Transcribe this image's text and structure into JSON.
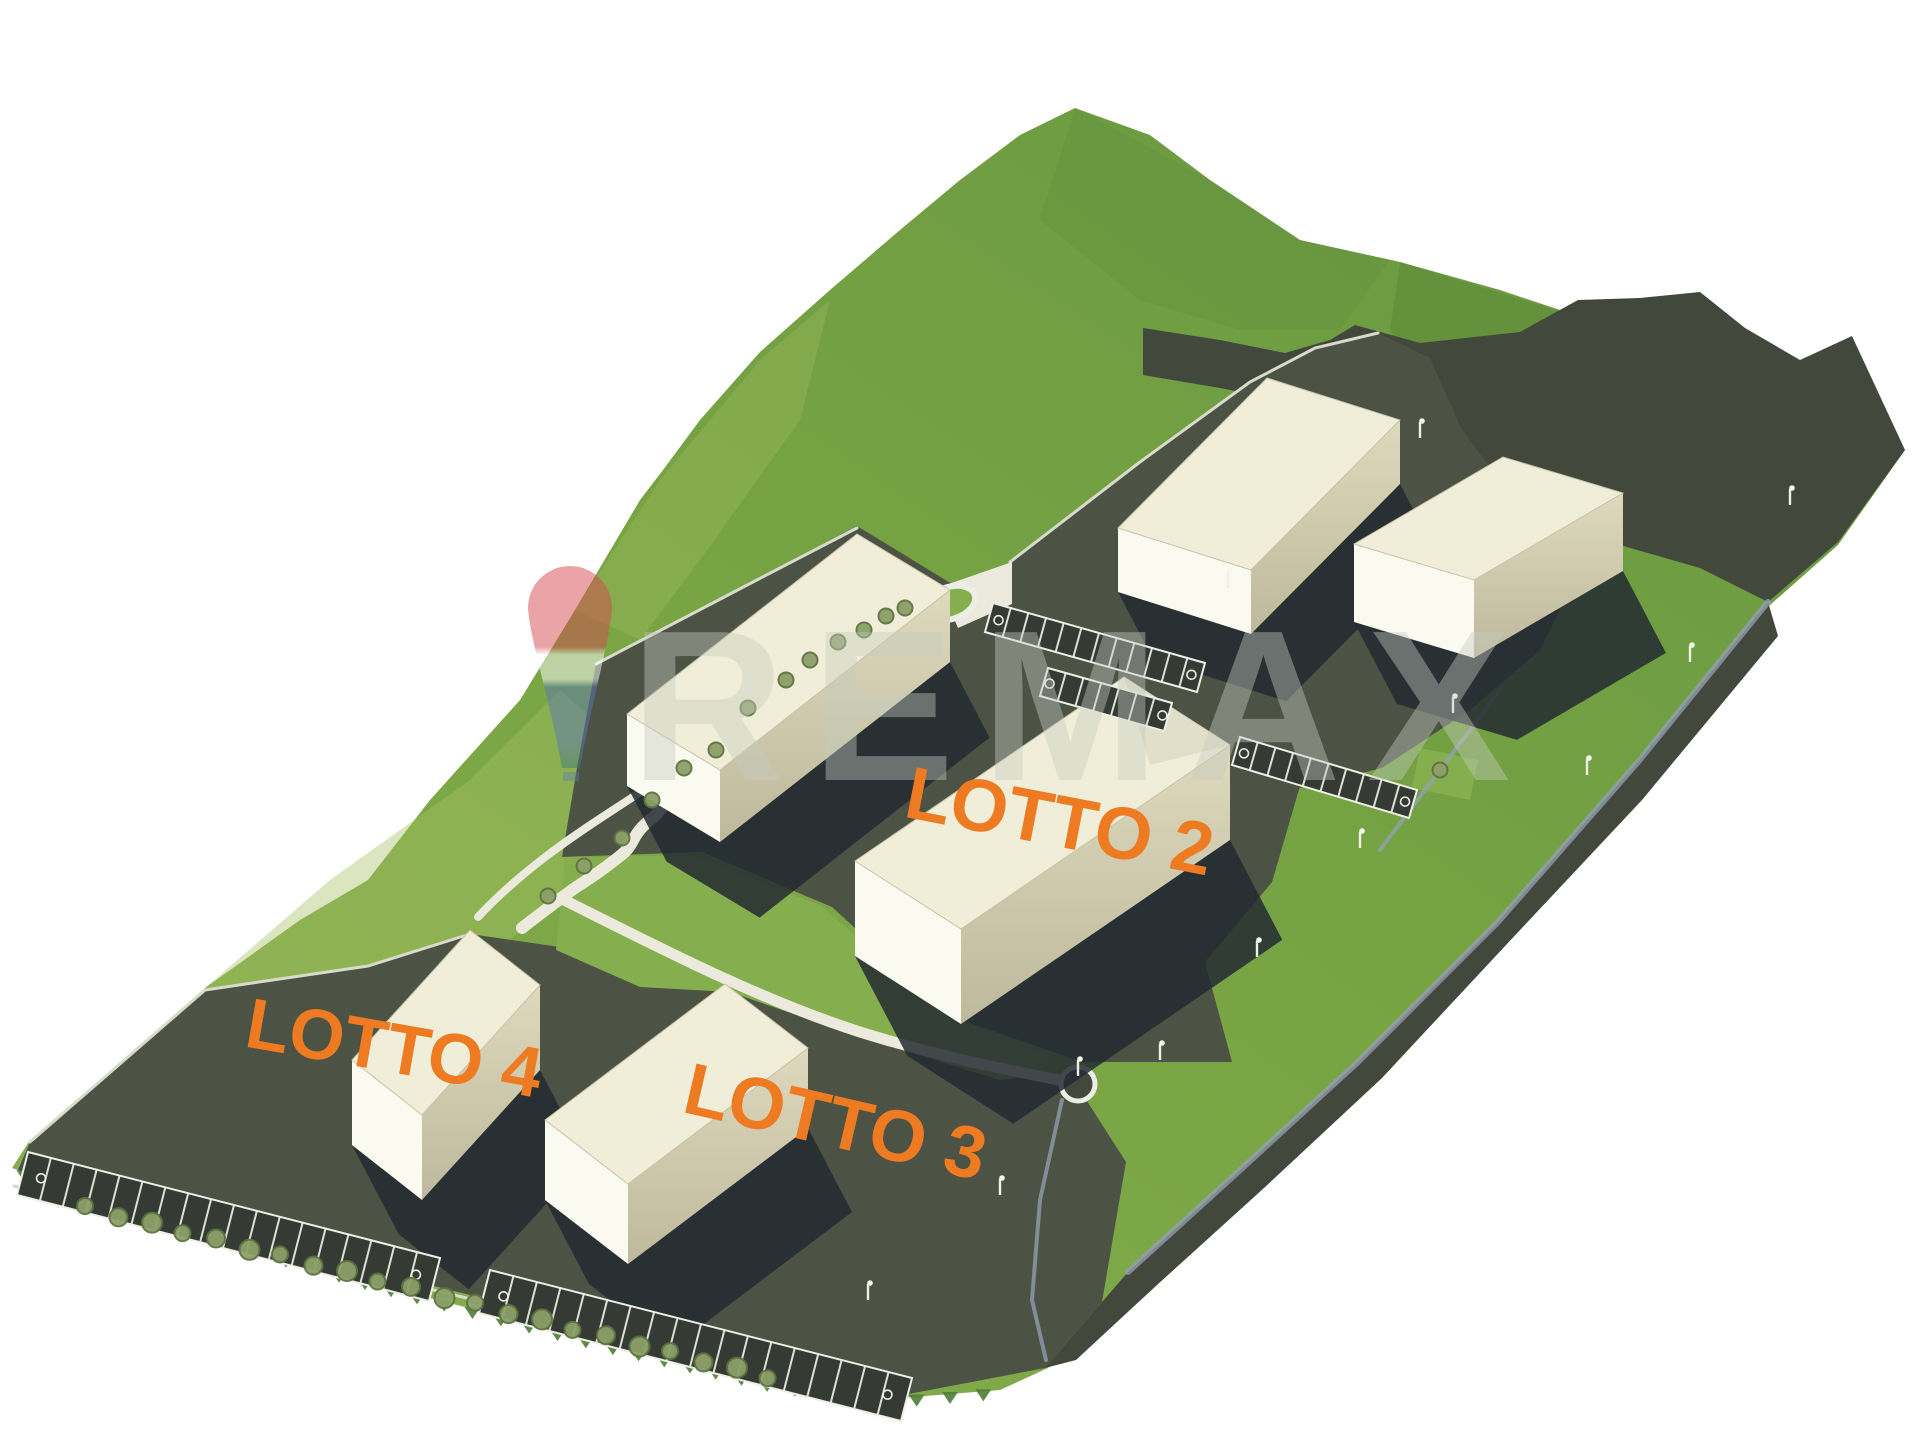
{
  "labels": {
    "lotto2": "LOTTO 2",
    "lotto3": "LOTTO 3",
    "lotto4": "LOTTO 4"
  },
  "watermark": {
    "text": "REMAX",
    "balloon_red": "#D4494F",
    "balloon_white": "#FFFFFF",
    "balloon_blue": "#5C77B2",
    "balloon_tip_teal": "#3E7F71",
    "letters_gray": "#C6CCC0"
  },
  "palette": {
    "background": "#FFFFFF",
    "accent_orange": "#EE7B22",
    "terrain_green": "#79A544",
    "terrain_green_deep": "#64923C",
    "terrain_green_dark": "#4F7D35",
    "terrain_green_light": "#A6C163",
    "terrain_green_tongue": "#85AE4E",
    "asphalt": "#4C5244",
    "asphalt_dark": "#42483C",
    "building_shadow": "#232A31",
    "building_top": "#F0EDD8",
    "building_front": "#FBFAF1",
    "building_side": "#DBD6B9",
    "path_light": "#ECEADC",
    "curb_light": "#D9DBCA",
    "white_line": "#EDEFE6",
    "sidewalk_blue": "#96A0B5",
    "tree_green": "#8CA068",
    "tree_green_dark": "#5E7342"
  }
}
